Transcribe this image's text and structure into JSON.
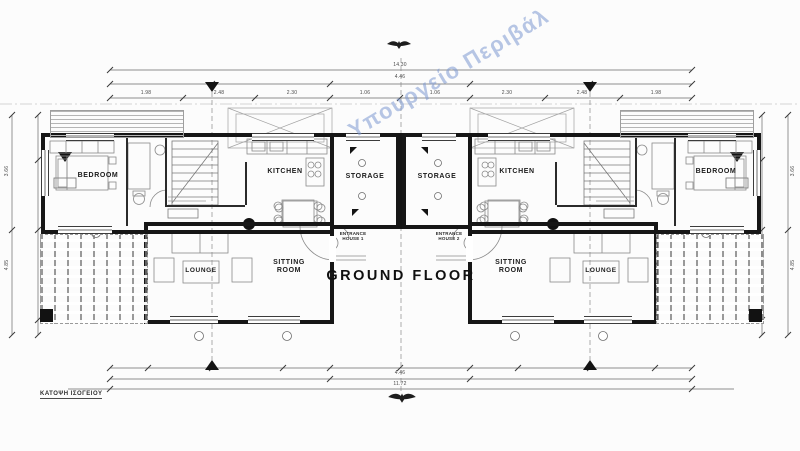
{
  "watermark": {
    "text": "Υπουργείο Περιβάλ",
    "color": "#7d99d1"
  },
  "title": "GROUND FLOOR",
  "drawing_label": "ΚΑΤΟΨΗ ΙΣΟΓΕΙΟΥ",
  "houses": {
    "left": {
      "bedroom": "BEDROOM",
      "kitchen": "KITCHEN",
      "storage": "STORAGE",
      "lounge": "LOUNGE",
      "sitting_room": "SITTING ROOM",
      "entrance": "ENTRANCE HOUSE 1"
    },
    "right": {
      "bedroom": "BEDROOM",
      "kitchen": "KITCHEN",
      "storage": "STORAGE",
      "lounge": "LOUNGE",
      "sitting_room": "SITTING ROOM",
      "entrance": "ENTRANCE HOUSE 2"
    }
  },
  "dimensions": {
    "top_total": "14.30",
    "top_sub": "4.46",
    "bottom_sub": "4.46",
    "bottom_total": "11.72",
    "top_segments": [
      "1.98",
      "2.48",
      "2.30",
      "1.06",
      "1.06",
      "2.30",
      "2.48",
      "1.98"
    ],
    "left_side": [
      "3.66",
      "4.85"
    ],
    "right_side": [
      "3.66",
      "4.85"
    ]
  },
  "colors": {
    "wall": "#161616",
    "thin_line": "#6a6a6a",
    "watermark": "#7d99d1"
  }
}
